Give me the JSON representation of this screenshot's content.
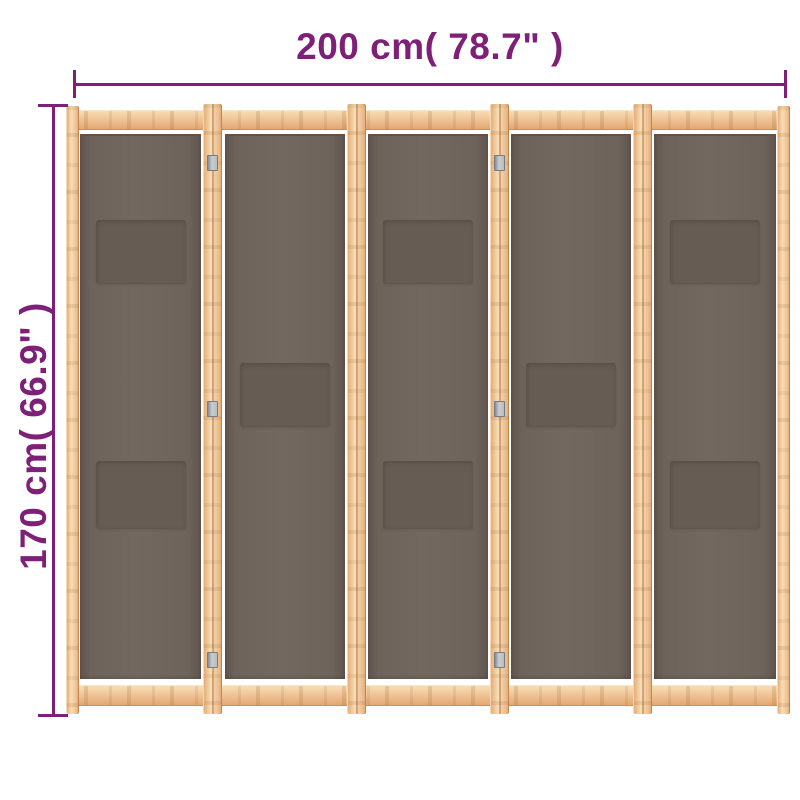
{
  "dimensions": {
    "width_label": "200 cm( 78.7\" )",
    "height_label": "170 cm( 66.9\" )",
    "width_cm": 200,
    "width_inches": 78.7,
    "height_cm": 170,
    "height_inches": 66.9
  },
  "colors": {
    "accent": "#7e1f78",
    "wood": "#efc193",
    "wood_hi": "#f8ddb4",
    "wood_dark": "#e2a873",
    "fabric": "#6e635b",
    "pocket": "#665c54",
    "hinge": "#b7bcbf"
  },
  "product": {
    "panel_count": 5,
    "panels": [
      {
        "pockets": [
          "top",
          "bottom"
        ]
      },
      {
        "pockets": [
          "middle"
        ]
      },
      {
        "pockets": [
          "top",
          "bottom"
        ]
      },
      {
        "pockets": [
          "middle"
        ]
      },
      {
        "pockets": [
          "top",
          "bottom"
        ]
      }
    ],
    "hinged_junctions": [
      0,
      2
    ],
    "hinges_per_junction": 3
  }
}
